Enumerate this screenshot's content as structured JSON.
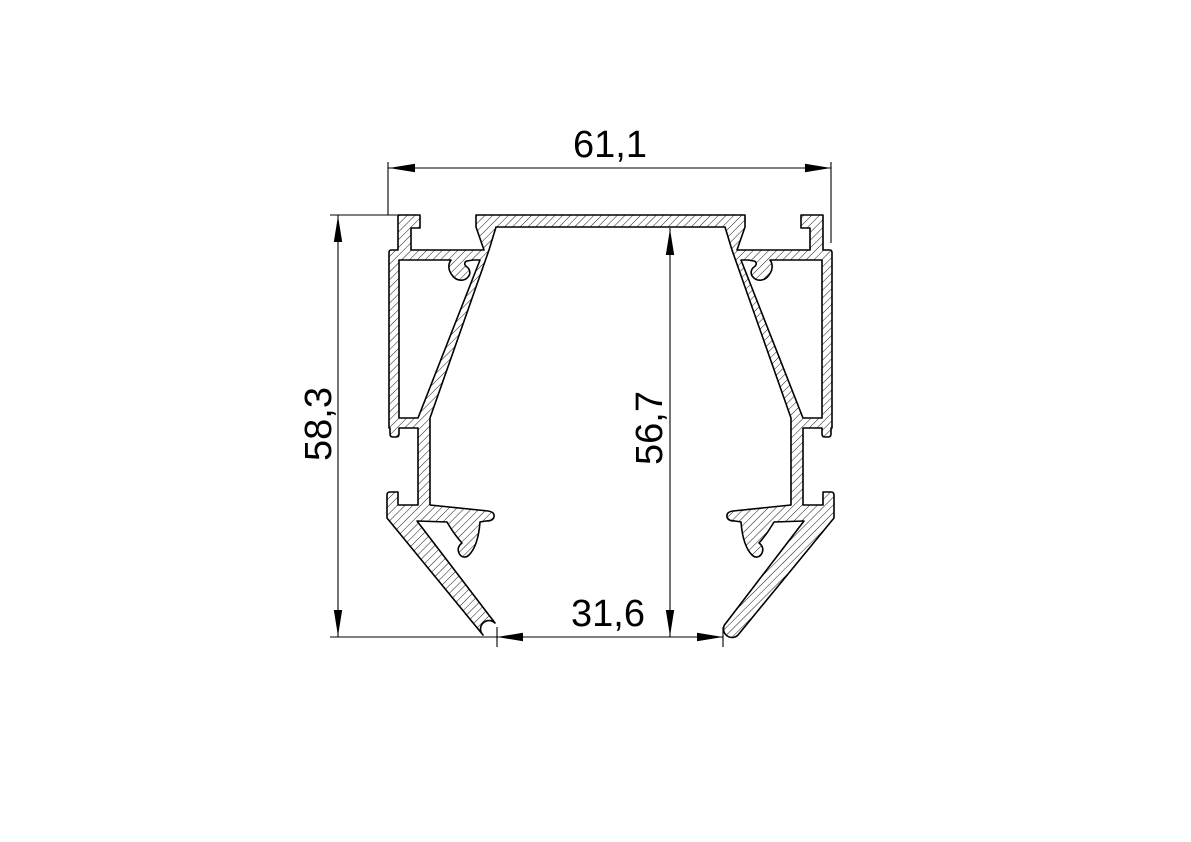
{
  "drawing": {
    "type": "technical-cross-section",
    "background_color": "#ffffff",
    "line_color": "#000000",
    "hatch_style": "diagonal-45",
    "dimensions": {
      "width_top": "61,1",
      "height_overall": "58,3",
      "height_inner": "56,7",
      "width_bottom_opening": "31,6"
    }
  }
}
